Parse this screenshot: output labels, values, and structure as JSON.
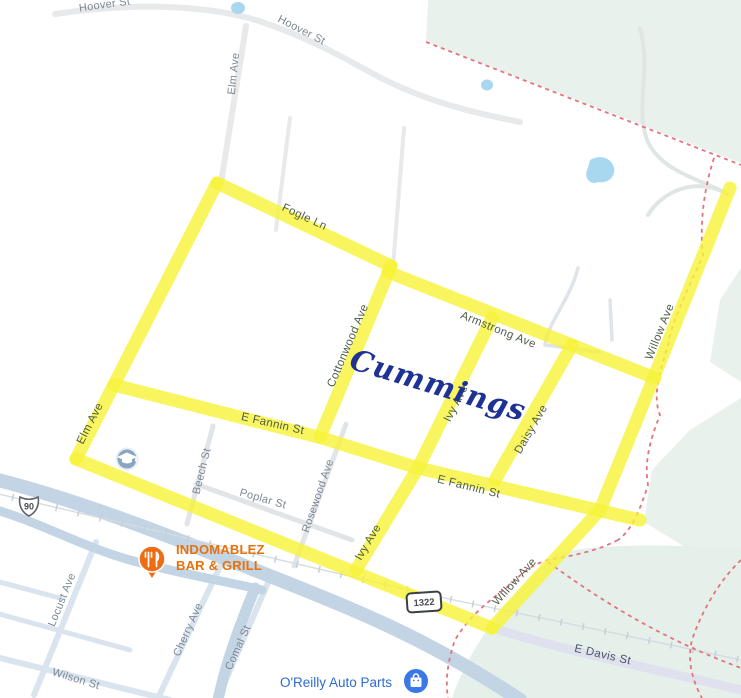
{
  "map": {
    "labels": {
      "hoover_st_1": "Hoover St",
      "hoover_st_2": "Hoover St",
      "elm_ave_north": "Elm Ave",
      "elm_ave_south": "Elm Ave",
      "fogle_ln": "Fogle Ln",
      "armstrong_ave": "Armstrong Ave",
      "cottonwood_ave": "Cottonwood Ave",
      "ivy_ave_north": "Ivy Ave",
      "ivy_ave_south": "Ivy Ave",
      "daisy_ave": "Daisy Ave",
      "willow_ave_north": "Willow Ave",
      "willow_ave_south": "Willow Ave",
      "e_fannin_st_west": "E Fannin St",
      "e_fannin_st_east": "E Fannin St",
      "beech_st": "Beech St",
      "poplar_st": "Poplar St",
      "rosewood_ave": "Rosewood Ave",
      "locust_ave": "Locust Ave",
      "cherry_ave": "Cherry Ave",
      "comal_st": "Comal St",
      "wilson_st": "Wilson St",
      "e_davis_st": "E Davis St"
    },
    "annotation": {
      "text": "Cummings",
      "color": "#1e3296"
    },
    "pois": {
      "indomablez": {
        "line1": "INDOMABLEZ",
        "line2": "BAR & GRILL",
        "color": "#e8710a",
        "icon": "restaurant-fork-knife"
      },
      "oreilly": {
        "name": "O'Reilly Auto Parts",
        "color": "#2e6bd3",
        "icon": "shopping-bag"
      },
      "school": {
        "icon": "graduation-cap"
      }
    },
    "shields": {
      "us_route": "90",
      "fm_route": "1322"
    },
    "colors": {
      "highlight_yellow": "#f7f33a",
      "water_blue": "#a8d7f0",
      "park_green": "#e8f1ec",
      "boundary_red": "#e4737f",
      "creek_gray_blue": "#c3d4e4",
      "minor_road_gray": "#e7e9ea",
      "bottomleft_road_blue_gray": "#dae4ee"
    }
  }
}
